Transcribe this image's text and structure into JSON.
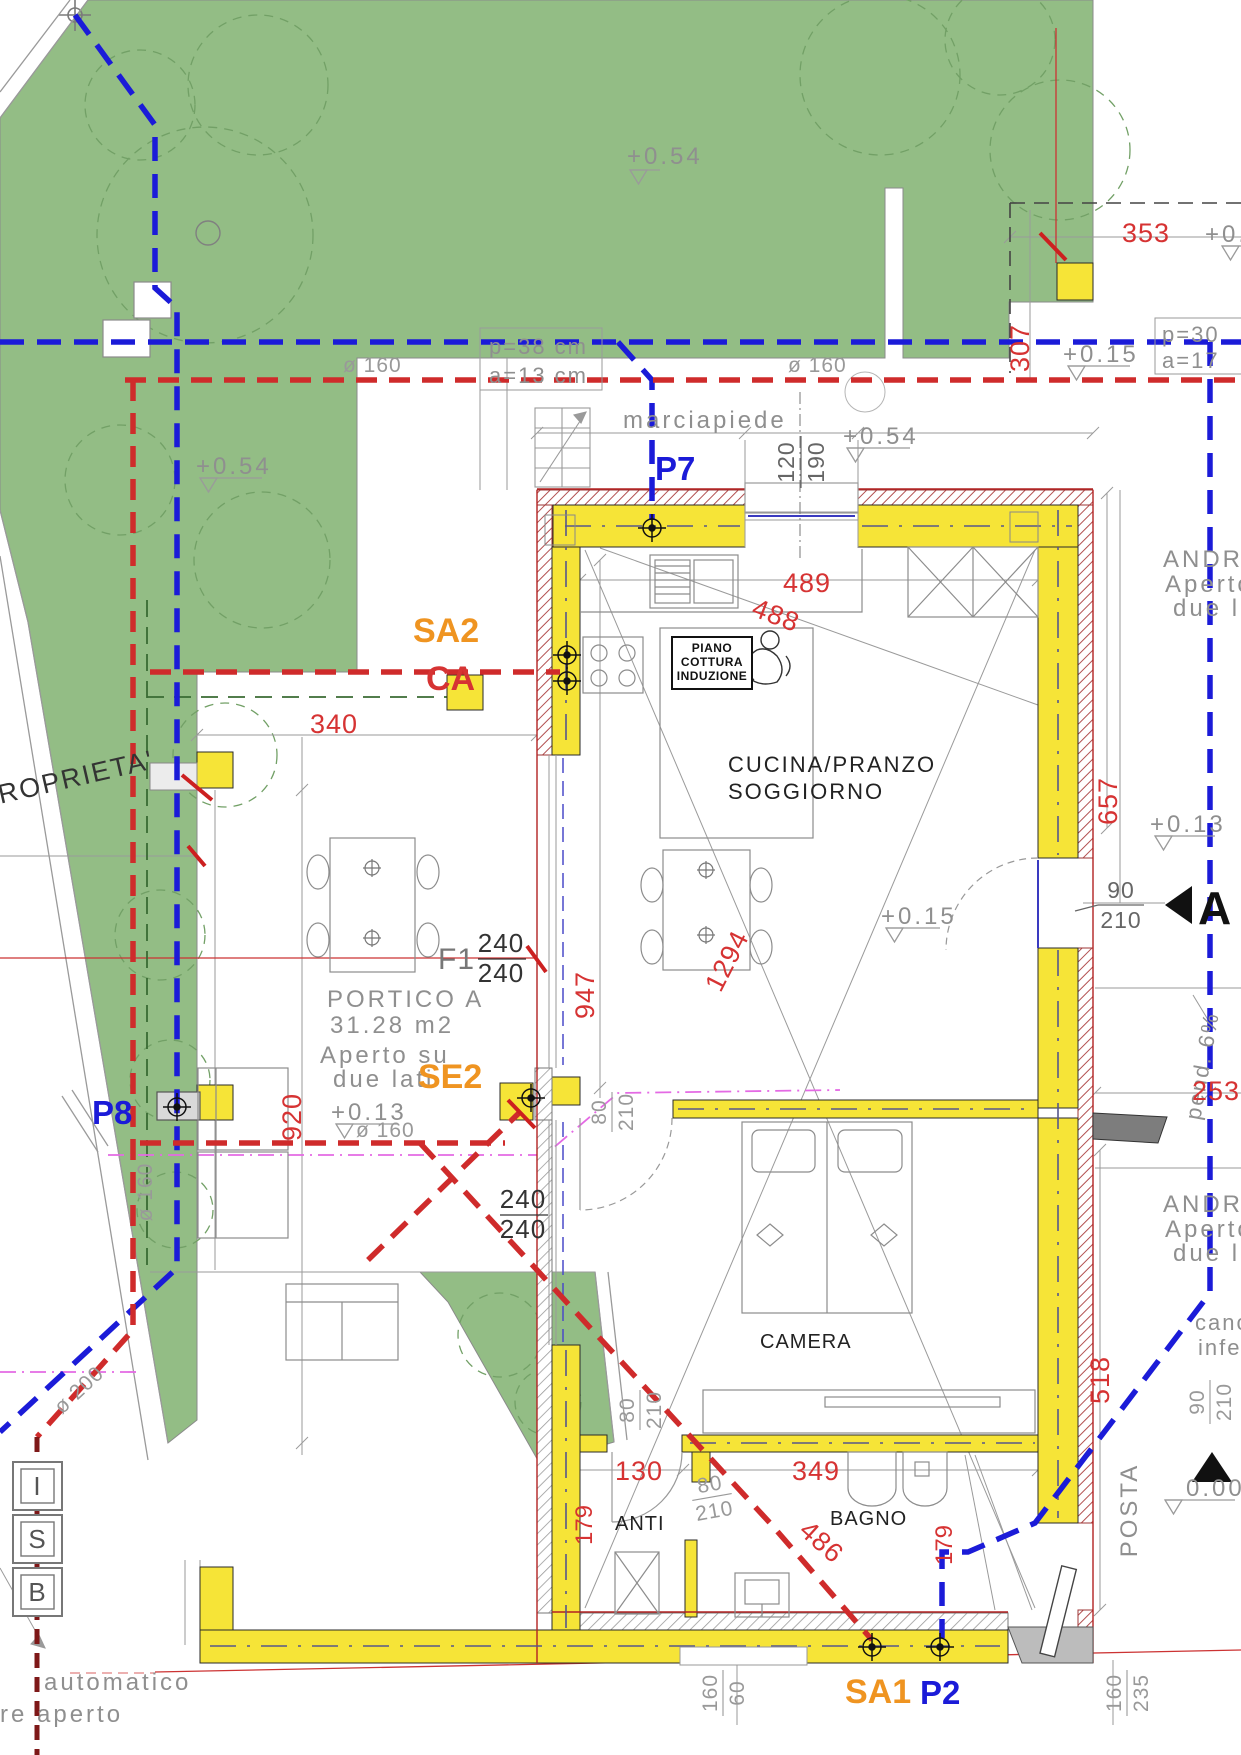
{
  "rooms": {
    "kitchen1": "CUCINA/PRANZO",
    "kitchen2": "SOGGIORNO",
    "camera": "CAMERA",
    "bagno": "BAGNO",
    "anti": "ANTI",
    "portico1": "PORTICO A",
    "portico2": "31.28 m2",
    "portico3": "Aperto su",
    "portico4": "due lati",
    "androne": "ANDRONE",
    "aperto": "Aperto",
    "due_lat": "due lat",
    "marciapiede": "marciapiede",
    "posta": "POSTA",
    "cott1": "PIANO",
    "cott2": "COTTURA",
    "cott3": "INDUZIONE"
  },
  "labels": {
    "p7": "P7",
    "p8": "P8",
    "p2": "P2",
    "sa1": "SA1",
    "sa2": "SA2",
    "se2": "SE2",
    "ca": "CA",
    "f1": "F1"
  },
  "pipes": {
    "d160": "ø 160",
    "d200": "ø 200",
    "p38": "p=38 cm",
    "a13": "a=13 cm",
    "p30": "p=30",
    "a17": "a=17",
    "pend": "pend. 6%"
  },
  "dims": {
    "d353": "353",
    "d307": "307",
    "d340": "340",
    "d489": "489",
    "d488": "488",
    "d920": "920",
    "d947": "947",
    "d1294": "1294",
    "d657": "657",
    "d253": "253",
    "d518": "518",
    "d130": "130",
    "d349": "349",
    "d486": "486",
    "d179": "179"
  },
  "frac": {
    "f120_190": {
      "a": "120",
      "b": "190"
    },
    "f240": {
      "a": "240",
      "b": "240"
    },
    "f80": {
      "a": "80",
      "b": "210"
    },
    "f90": {
      "a": "90",
      "b": "210"
    },
    "f160_60": {
      "a": "160",
      "b": "60"
    },
    "f160_235": {
      "a": "160",
      "b": "235"
    }
  },
  "elev": {
    "p054": "+0.54",
    "p015": "+0.15",
    "p013": "+0.13",
    "z000": "0.00",
    "p04": "+0.4"
  },
  "markers": {
    "a": "A",
    "i": "I",
    "s": "S",
    "b": "B"
  },
  "notes": {
    "proprieta": "ROPRIETA'",
    "automatico": "automatico",
    "re_aperto": "re aperto",
    "canc": "canc",
    "infer": "infer"
  },
  "colors": {
    "grass": "#93bd85",
    "wall_yellow": "#f6e437",
    "pipe_blue": "#1b1bd8",
    "pipe_red": "#cf2b2b",
    "pipe_maroon": "#7e1818",
    "magenta": "#e46ae4",
    "label_orange": "#ef9421",
    "dim_red": "#d63333",
    "dark_green": "#3a6b33"
  }
}
